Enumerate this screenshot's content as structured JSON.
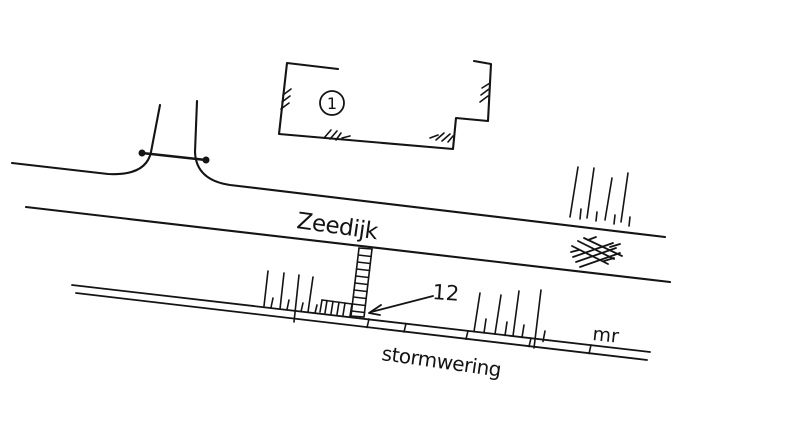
{
  "canvas": {
    "background": "#ffffff",
    "ink": "#141414"
  },
  "map": {
    "building_number": "1",
    "street_label": "Zeedijk",
    "structure_number": "12",
    "barrier_label": "stormwering",
    "note_label": "mr"
  }
}
